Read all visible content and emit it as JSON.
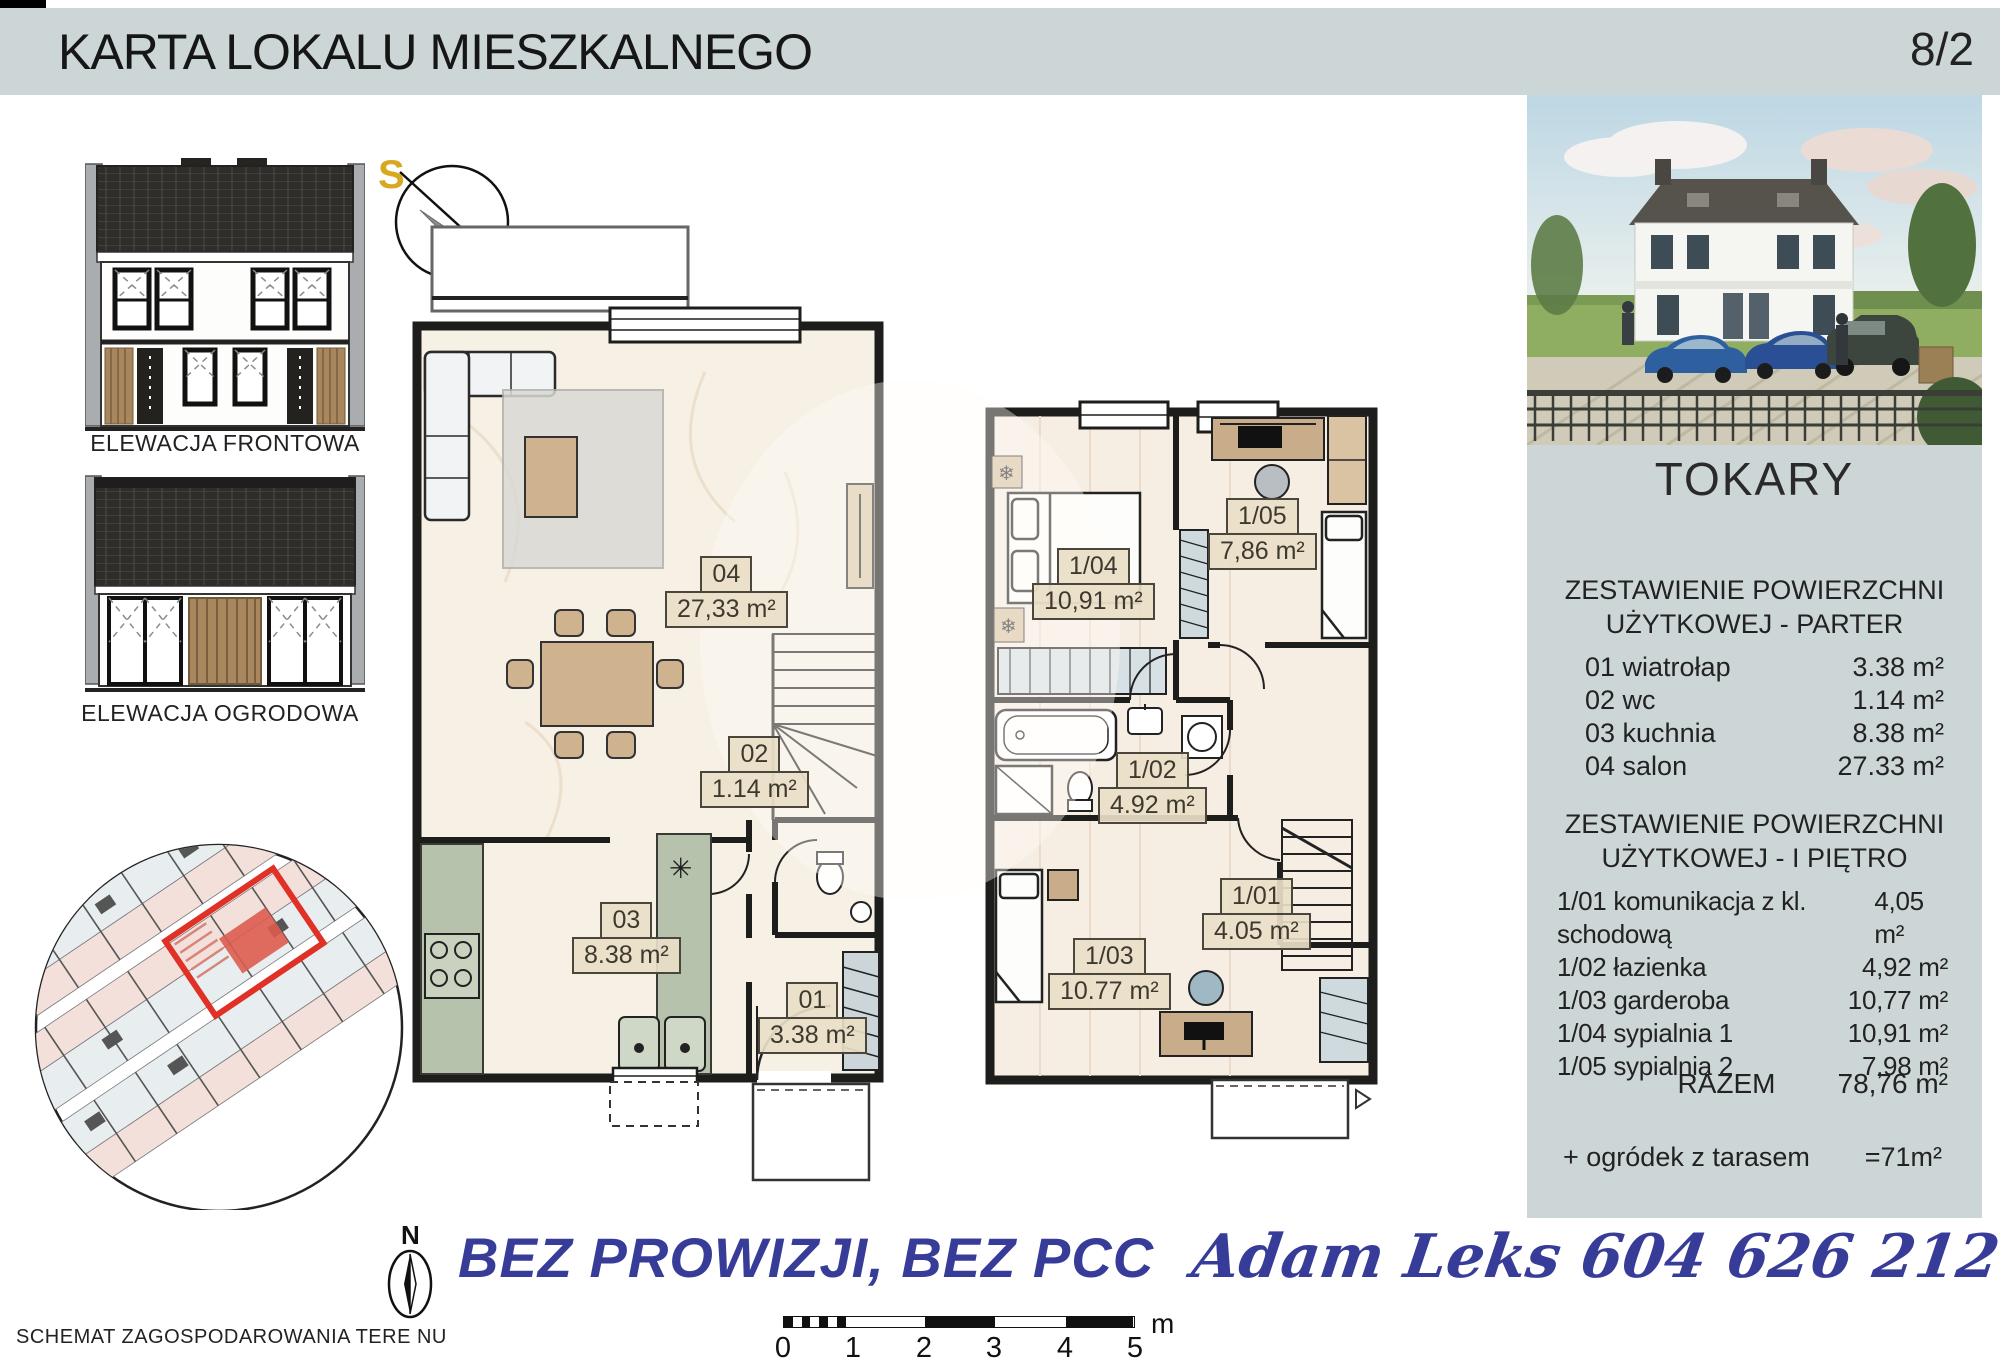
{
  "header": {
    "title": "KARTA LOKALU MIESZKALNEGO",
    "page_number": "8/2"
  },
  "elevations": {
    "front_label": "ELEWACJA FRONTOWA",
    "garden_label": "ELEWACJA OGRODOWA"
  },
  "compass": {
    "south": "S",
    "north": "N"
  },
  "compass_small": {
    "north": "N"
  },
  "icons": {
    "radiator": "❄",
    "vent": "✳"
  },
  "plans": {
    "ground": {
      "rooms": [
        {
          "id": "04",
          "area": "27,33 m²"
        },
        {
          "id": "02",
          "area": "1.14 m²"
        },
        {
          "id": "03",
          "area": "8.38 m²"
        },
        {
          "id": "01",
          "area": "3.38 m²"
        }
      ]
    },
    "first": {
      "rooms": [
        {
          "id": "1/04",
          "area": "10,91 m²"
        },
        {
          "id": "1/05",
          "area": "7,86 m²"
        },
        {
          "id": "1/02",
          "area": "4.92 m²"
        },
        {
          "id": "1/03",
          "area": "10.77 m²"
        },
        {
          "id": "1/01",
          "area": "4.05 m²"
        }
      ]
    }
  },
  "sidebar": {
    "project_name": "TOKARY",
    "parter_heading_line1": "ZESTAWIENIE POWIERZCHNI",
    "parter_heading_line2": "UŻYTKOWEJ - PARTER",
    "parter_rows": [
      {
        "label": "01 wiatrołap",
        "value": "3.38 m²"
      },
      {
        "label": "02 wc",
        "value": "1.14 m²"
      },
      {
        "label": "03 kuchnia",
        "value": "8.38 m²"
      },
      {
        "label": "04 salon",
        "value": "27.33 m²"
      }
    ],
    "pietro_heading_line1": "ZESTAWIENIE POWIERZCHNI",
    "pietro_heading_line2": "UŻYTKOWEJ - I PIĘTRO",
    "pietro_rows": [
      {
        "label": "1/01 komunikacja z kl. schodową",
        "value": "4,05 m²"
      },
      {
        "label": "1/02 łazienka",
        "value": "4,92 m²"
      },
      {
        "label": "1/03 garderoba",
        "value": "10,77 m²"
      },
      {
        "label": "1/04 sypialnia 1",
        "value": "10,91 m²"
      },
      {
        "label": "1/05 sypialnia 2",
        "value": "7,98 m²"
      }
    ],
    "total_label": "RAZEM",
    "total_value": "78,76 m²",
    "garden_label": "+ ogródek z tarasem",
    "garden_value": "=71m²"
  },
  "siteplan": {
    "caption": "SCHEMAT ZAGOSPODAROWANIA TERE NU"
  },
  "marketing": {
    "slogan": "BEZ PROWIZJI, BEZ PCC",
    "agent": "Adam Leks 604 626 212"
  },
  "scalebar": {
    "ticks": [
      "0",
      "1",
      "2",
      "3",
      "4",
      "5"
    ],
    "unit": "m"
  },
  "colors": {
    "panel_bg": "#cdd6d7",
    "accent_red": "#e03127",
    "brand_blue": "#383c99"
  }
}
